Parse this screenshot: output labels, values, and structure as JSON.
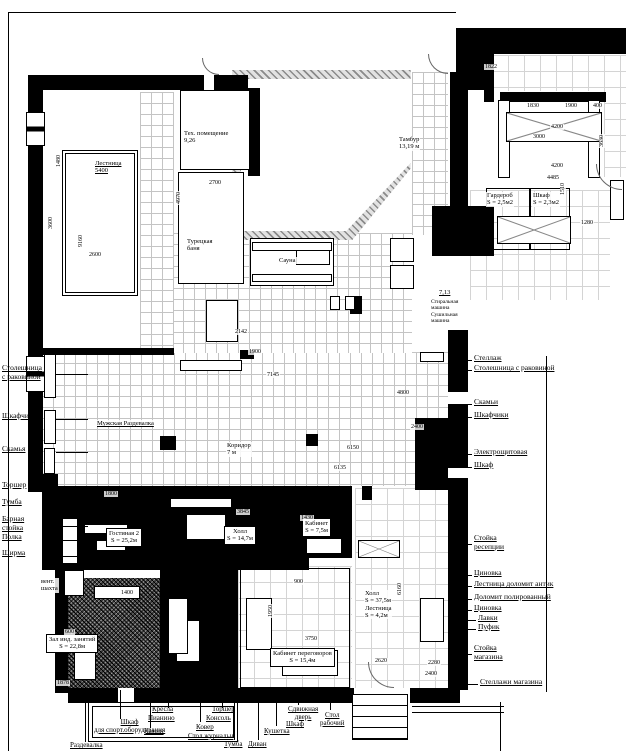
{
  "labels": [
    {
      "t": "Тех. помещение\n9,26",
      "x": 183,
      "y": 130
    },
    {
      "t": "Турецкая\nбаня",
      "x": 186,
      "y": 238
    },
    {
      "t": "Сауна",
      "x": 278,
      "y": 257
    },
    {
      "t": "Лестница\n5400",
      "x": 94,
      "y": 160,
      "cls": "ul"
    },
    {
      "t": "Тамбур\n13,19 м",
      "x": 398,
      "y": 136
    },
    {
      "t": "Мужская Раздевалка",
      "x": 96,
      "y": 420,
      "cls": "ul"
    },
    {
      "t": "Коридор\n7 м",
      "x": 226,
      "y": 442
    },
    {
      "t": "Гардероб\nS = 2,5м2",
      "x": 486,
      "y": 192
    },
    {
      "t": "Шкаф\nS = 2,3м2",
      "x": 532,
      "y": 192
    },
    {
      "t": "7,13",
      "x": 438,
      "y": 289,
      "cls": "ul"
    },
    {
      "t": "Стиральная\nмашина",
      "x": 430,
      "y": 299,
      "cls": "tiny"
    },
    {
      "t": "Сушильная\nмашина",
      "x": 430,
      "y": 312,
      "cls": "tiny"
    },
    {
      "t": "Гостиная 2\nS = 25,2м",
      "x": 106,
      "y": 528,
      "cls": "boxed"
    },
    {
      "t": "Холл\nS = 14,7м",
      "x": 224,
      "y": 526,
      "cls": "boxed"
    },
    {
      "t": "Кабинет\nS = 7,5м",
      "x": 302,
      "y": 518,
      "cls": "boxed"
    },
    {
      "t": "Холл\nS = 37,5м\nЛестница\nS = 4,2м",
      "x": 364,
      "y": 590
    },
    {
      "t": "Кабинет переговоров\nS = 15,4м",
      "x": 270,
      "y": 648,
      "cls": "boxed"
    },
    {
      "t": "Зал инд. занятий\nS = 22,8м",
      "x": 46,
      "y": 634,
      "cls": "boxed"
    },
    {
      "t": "вент.\nшахта",
      "x": 40,
      "y": 578
    }
  ],
  "dims": [
    {
      "t": "2700",
      "x": 208,
      "y": 180
    },
    {
      "t": "4970",
      "x": 176,
      "y": 205,
      "cls": "rot"
    },
    {
      "t": "3600",
      "x": 48,
      "y": 230,
      "cls": "rot"
    },
    {
      "t": "9160",
      "x": 78,
      "y": 248,
      "cls": "rot"
    },
    {
      "t": "2600",
      "x": 88,
      "y": 252
    },
    {
      "t": "1480",
      "x": 56,
      "y": 168,
      "cls": "rot"
    },
    {
      "t": "1822",
      "x": 484,
      "y": 64
    },
    {
      "t": "1830",
      "x": 526,
      "y": 103
    },
    {
      "t": "1900",
      "x": 564,
      "y": 103
    },
    {
      "t": "400",
      "x": 592,
      "y": 103
    },
    {
      "t": "3000",
      "x": 532,
      "y": 134
    },
    {
      "t": "4200",
      "x": 550,
      "y": 124
    },
    {
      "t": "4200",
      "x": 550,
      "y": 163
    },
    {
      "t": "4485",
      "x": 546,
      "y": 175
    },
    {
      "t": "1280",
      "x": 580,
      "y": 220
    },
    {
      "t": "1510",
      "x": 560,
      "y": 196,
      "cls": "rot"
    },
    {
      "t": "3630",
      "x": 599,
      "y": 148,
      "cls": "rot"
    },
    {
      "t": "1900",
      "x": 248,
      "y": 349
    },
    {
      "t": "7145",
      "x": 266,
      "y": 372
    },
    {
      "t": "2142",
      "x": 234,
      "y": 329
    },
    {
      "t": "4800",
      "x": 396,
      "y": 390
    },
    {
      "t": "2400",
      "x": 410,
      "y": 424
    },
    {
      "t": "6150",
      "x": 346,
      "y": 445
    },
    {
      "t": "6135",
      "x": 333,
      "y": 465
    },
    {
      "t": "900",
      "x": 293,
      "y": 579
    },
    {
      "t": "1950",
      "x": 268,
      "y": 618,
      "cls": "rot"
    },
    {
      "t": "3750",
      "x": 304,
      "y": 636
    },
    {
      "t": "2620",
      "x": 374,
      "y": 658
    },
    {
      "t": "2280",
      "x": 427,
      "y": 660
    },
    {
      "t": "2400",
      "x": 424,
      "y": 671
    },
    {
      "t": "1878",
      "x": 56,
      "y": 680
    },
    {
      "t": "600",
      "x": 64,
      "y": 629
    },
    {
      "t": "1400",
      "x": 120,
      "y": 590
    },
    {
      "t": "6160",
      "x": 397,
      "y": 596,
      "cls": "rot"
    },
    {
      "t": "1430",
      "x": 300,
      "y": 515
    },
    {
      "t": "3845",
      "x": 236,
      "y": 509
    },
    {
      "t": "1800",
      "x": 104,
      "y": 491
    }
  ],
  "left_annotations": [
    {
      "t": "Столешница\nс раковиной",
      "x": 2,
      "y": 364,
      "leader": [
        56,
        374,
        32,
        1
      ]
    },
    {
      "t": "Шкафчики",
      "x": 2,
      "y": 412,
      "leader": [
        56,
        419,
        32,
        1
      ]
    },
    {
      "t": "Скамья",
      "x": 2,
      "y": 445,
      "leader": [
        56,
        452,
        32,
        1
      ]
    },
    {
      "t": "Торшер",
      "x": 2,
      "y": 481,
      "leader": [
        56,
        488,
        32,
        1
      ]
    },
    {
      "t": "Тумба",
      "x": 2,
      "y": 498,
      "leader": [
        56,
        505,
        32,
        1
      ]
    },
    {
      "t": "Барная\nстойка",
      "x": 2,
      "y": 515,
      "leader": [
        56,
        526,
        32,
        1
      ]
    },
    {
      "t": "Полка",
      "x": 2,
      "y": 533,
      "leader": [
        56,
        540,
        32,
        1
      ]
    },
    {
      "t": "Ширма",
      "x": 2,
      "y": 549,
      "leader": [
        56,
        556,
        32,
        1
      ]
    }
  ],
  "right_annotations": [
    {
      "t": "Стеллаж",
      "x": 474,
      "y": 354,
      "leader": [
        452,
        360,
        20,
        1
      ]
    },
    {
      "t": "Столешница с раковиной",
      "x": 474,
      "y": 364,
      "leader": [
        452,
        370,
        20,
        1
      ]
    },
    {
      "t": "Скамьи",
      "x": 474,
      "y": 398,
      "leader": [
        452,
        404,
        20,
        1
      ]
    },
    {
      "t": "Шкафчики",
      "x": 474,
      "y": 411,
      "leader": [
        452,
        417,
        20,
        1
      ]
    },
    {
      "t": "Электрощитовая",
      "x": 474,
      "y": 448,
      "leader": [
        452,
        454,
        20,
        1
      ]
    },
    {
      "t": "Шкаф",
      "x": 474,
      "y": 461,
      "leader": [
        452,
        467,
        20,
        1
      ]
    },
    {
      "t": "Стойка\nресепции",
      "x": 474,
      "y": 534,
      "leader": [
        452,
        544,
        20,
        1
      ]
    },
    {
      "t": "Циновка",
      "x": 474,
      "y": 569,
      "leader": [
        452,
        575,
        20,
        1
      ]
    },
    {
      "t": "Лестница доломит антик",
      "x": 474,
      "y": 580,
      "leader": [
        452,
        586,
        20,
        1
      ]
    },
    {
      "t": "Доломит полированный",
      "x": 474,
      "y": 593,
      "leader": [
        452,
        599,
        20,
        1
      ]
    },
    {
      "t": "Циновка",
      "x": 474,
      "y": 604,
      "leader": [
        452,
        610,
        20,
        1
      ]
    },
    {
      "t": "Лавки",
      "x": 478,
      "y": 614,
      "leader": [
        456,
        620,
        20,
        1
      ]
    },
    {
      "t": "Пуфик",
      "x": 478,
      "y": 623,
      "leader": [
        456,
        629,
        20,
        1
      ]
    },
    {
      "t": "Стойка\nмагазина",
      "x": 474,
      "y": 644,
      "leader": [
        452,
        654,
        20,
        1
      ]
    },
    {
      "t": "Стеллажи магазина",
      "x": 480,
      "y": 678,
      "leader": [
        458,
        684,
        20,
        1
      ]
    }
  ],
  "bottom_annotations": [
    {
      "t": "Раздевалка",
      "x": 70,
      "y": 742,
      "leader": [
        85,
        702,
        1,
        40
      ]
    },
    {
      "t": "Шкаф\nдля спорт.оборудования",
      "x": 94,
      "y": 719,
      "leader": [
        120,
        690,
        1,
        29
      ]
    },
    {
      "t": "Кресла",
      "x": 152,
      "y": 706,
      "leader": [
        168,
        690,
        1,
        18
      ]
    },
    {
      "t": "Пианино",
      "x": 148,
      "y": 715
    },
    {
      "t": "Камин",
      "x": 144,
      "y": 728,
      "leader": [
        150,
        690,
        1,
        38
      ]
    },
    {
      "t": "Торшер",
      "x": 212,
      "y": 706,
      "leader": [
        222,
        690,
        1,
        18
      ]
    },
    {
      "t": "Консоль",
      "x": 206,
      "y": 715
    },
    {
      "t": "Ковер",
      "x": 196,
      "y": 724,
      "leader": [
        200,
        690,
        1,
        32
      ]
    },
    {
      "t": "Стол журнальн",
      "x": 188,
      "y": 733
    },
    {
      "t": "Тумба",
      "x": 224,
      "y": 741,
      "leader": [
        234,
        690,
        1,
        50
      ]
    },
    {
      "t": "Диван",
      "x": 248,
      "y": 741,
      "leader": [
        258,
        690,
        1,
        50
      ]
    },
    {
      "t": "Кушетка",
      "x": 264,
      "y": 728,
      "leader": [
        276,
        690,
        1,
        36
      ]
    },
    {
      "t": "Шкаф",
      "x": 286,
      "y": 721
    },
    {
      "t": "Сдвижная\nдверь",
      "x": 288,
      "y": 706,
      "leader": [
        298,
        690,
        1,
        15
      ]
    },
    {
      "t": "Стол\nрабочий",
      "x": 320,
      "y": 712,
      "leader": [
        330,
        690,
        1,
        20
      ]
    }
  ]
}
